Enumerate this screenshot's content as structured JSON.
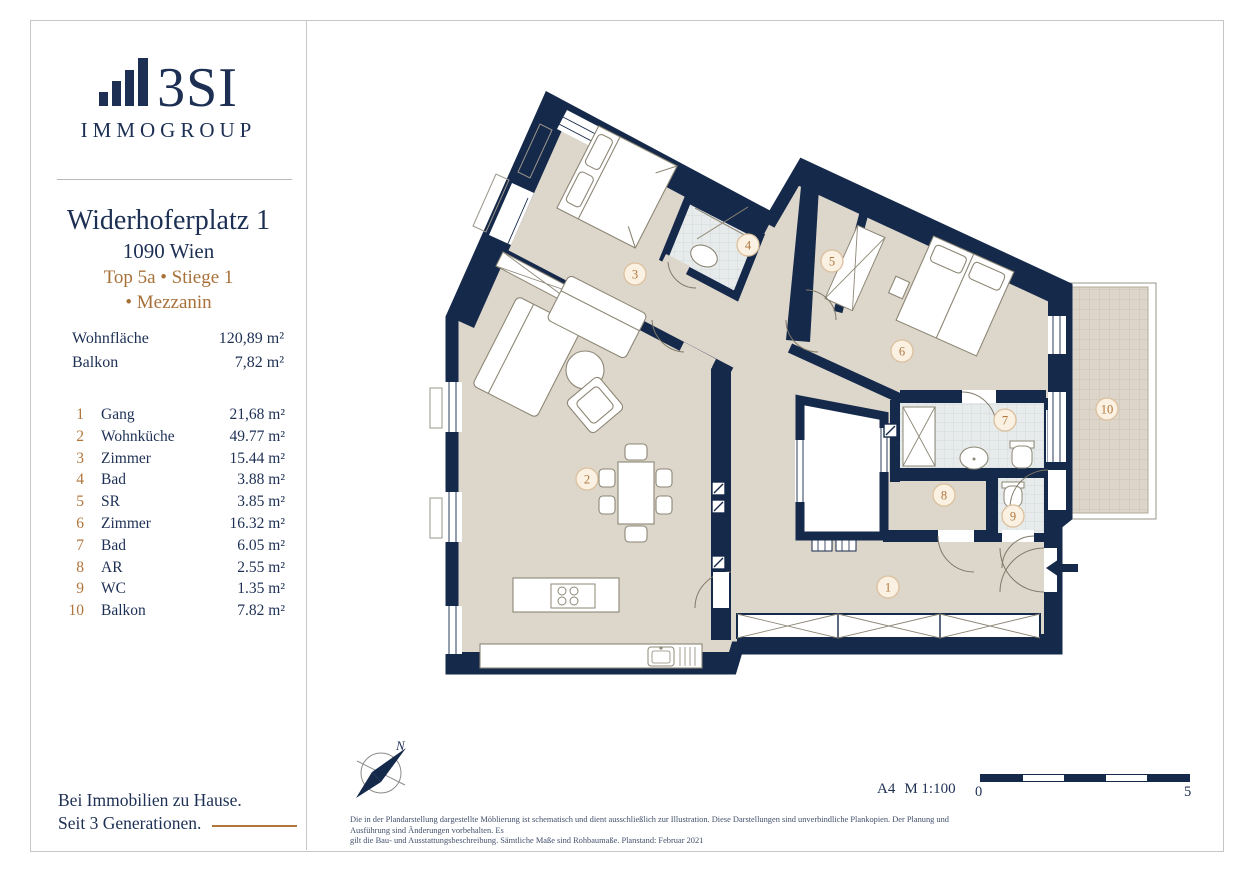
{
  "brand": {
    "name": "3SI",
    "subtitle": "IMMOGROUP",
    "tagline_line1": "Bei Immobilien zu Hause.",
    "tagline_line2": "Seit 3 Generationen."
  },
  "listing": {
    "address": "Widerhoferplatz 1",
    "city": "1090 Wien",
    "unit_line1": "Top 5a • Stiege 1",
    "unit_line2": "• Mezzanin"
  },
  "metrics": [
    {
      "label": "Wohnfläche",
      "value": "120,89 m²"
    },
    {
      "label": "Balkon",
      "value": "7,82 m²"
    }
  ],
  "rooms": [
    {
      "nr": "1",
      "name": "Gang",
      "area": "21,68 m²"
    },
    {
      "nr": "2",
      "name": "Wohnküche",
      "area": "49.77 m²"
    },
    {
      "nr": "3",
      "name": "Zimmer",
      "area": "15.44 m²"
    },
    {
      "nr": "4",
      "name": "Bad",
      "area": "3.88 m²"
    },
    {
      "nr": "5",
      "name": "SR",
      "area": "3.85 m²"
    },
    {
      "nr": "6",
      "name": "Zimmer",
      "area": "16.32 m²"
    },
    {
      "nr": "7",
      "name": "Bad",
      "area": "6.05 m²"
    },
    {
      "nr": "8",
      "name": "AR",
      "area": "2.55 m²"
    },
    {
      "nr": "9",
      "name": "WC",
      "area": "1.35 m²"
    },
    {
      "nr": "10",
      "name": "Balkon",
      "area": "7.82 m²"
    }
  ],
  "plan": {
    "labels": [
      {
        "n": "1",
        "x": 888,
        "y": 587
      },
      {
        "n": "2",
        "x": 587,
        "y": 479
      },
      {
        "n": "3",
        "x": 635,
        "y": 274
      },
      {
        "n": "4",
        "x": 748,
        "y": 245
      },
      {
        "n": "5",
        "x": 832,
        "y": 261
      },
      {
        "n": "6",
        "x": 902,
        "y": 351
      },
      {
        "n": "7",
        "x": 1005,
        "y": 420
      },
      {
        "n": "8",
        "x": 944,
        "y": 495
      },
      {
        "n": "9",
        "x": 1013,
        "y": 516
      },
      {
        "n": "10",
        "x": 1107,
        "y": 409
      }
    ],
    "north_label": "N",
    "sheet": "A4",
    "scale": "M 1:100",
    "scale_start": "0",
    "scale_end": "5"
  },
  "footer": {
    "disclaimer_line1": "Die in der Plandarstellung dargestellte Möblierung ist schematisch und dient ausschließlich zur Illustration. Diese Darstellungen sind unverbindliche Plankopien. Der Planung und Ausführung sind Änderungen vorbehalten. Es",
    "disclaimer_line2": "gilt die Bau- und Ausstattungsbeschreibung. Sämtliche Maße sind Rohbaumaße. Planstand: Februar 2021"
  },
  "colors": {
    "wall": "#15294b",
    "navy_text": "#1d3054",
    "accent_brown": "#a9713a",
    "label_brown": "#b0763c",
    "floor": "#ddd6cb",
    "bath_tile": "#e8ebeb",
    "label_circle_fill": "#faf1e3",
    "label_circle_border": "#dcc09c"
  }
}
